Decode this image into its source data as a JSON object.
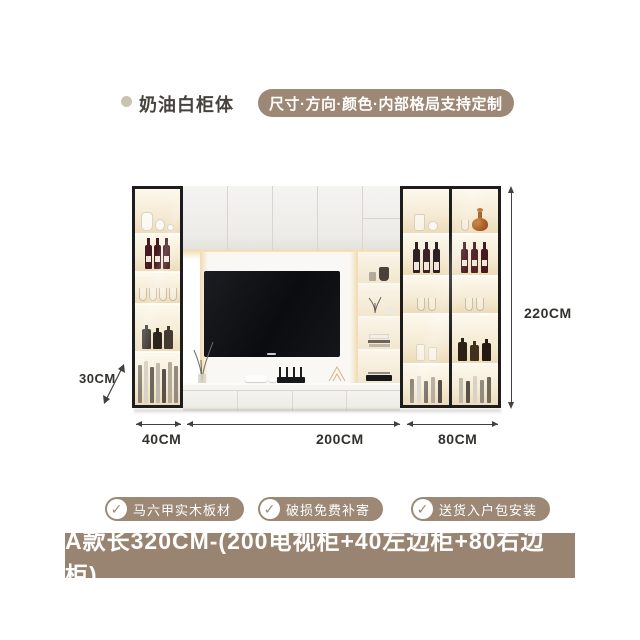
{
  "header": {
    "title": "奶油白柜体",
    "customize_badge": "尺寸·方向·颜色·内部格局支持定制"
  },
  "diagram": {
    "dimensions": {
      "total_height": "220CM",
      "depth": "30CM",
      "left_cabinet_width": "40CM",
      "tv_cabinet_width": "200CM",
      "right_cabinet_width": "80CM"
    }
  },
  "features": [
    {
      "icon": "check-icon",
      "label": "马六甲实木板材"
    },
    {
      "icon": "check-icon",
      "label": "破损免费补寄"
    },
    {
      "icon": "check-icon",
      "label": "送货入户包安装"
    }
  ],
  "footer": {
    "label": "A款长320CM-(200电视柜+40左边柜+80右边柜)"
  },
  "icons": {
    "check": "✓"
  },
  "colors": {
    "accent_taupe": "#9c8874",
    "footer_bar": "#998471",
    "dimension_text": "#33322f",
    "cabinet_frame": "#1d1d1d",
    "warm_glow": "#f2daa4"
  }
}
